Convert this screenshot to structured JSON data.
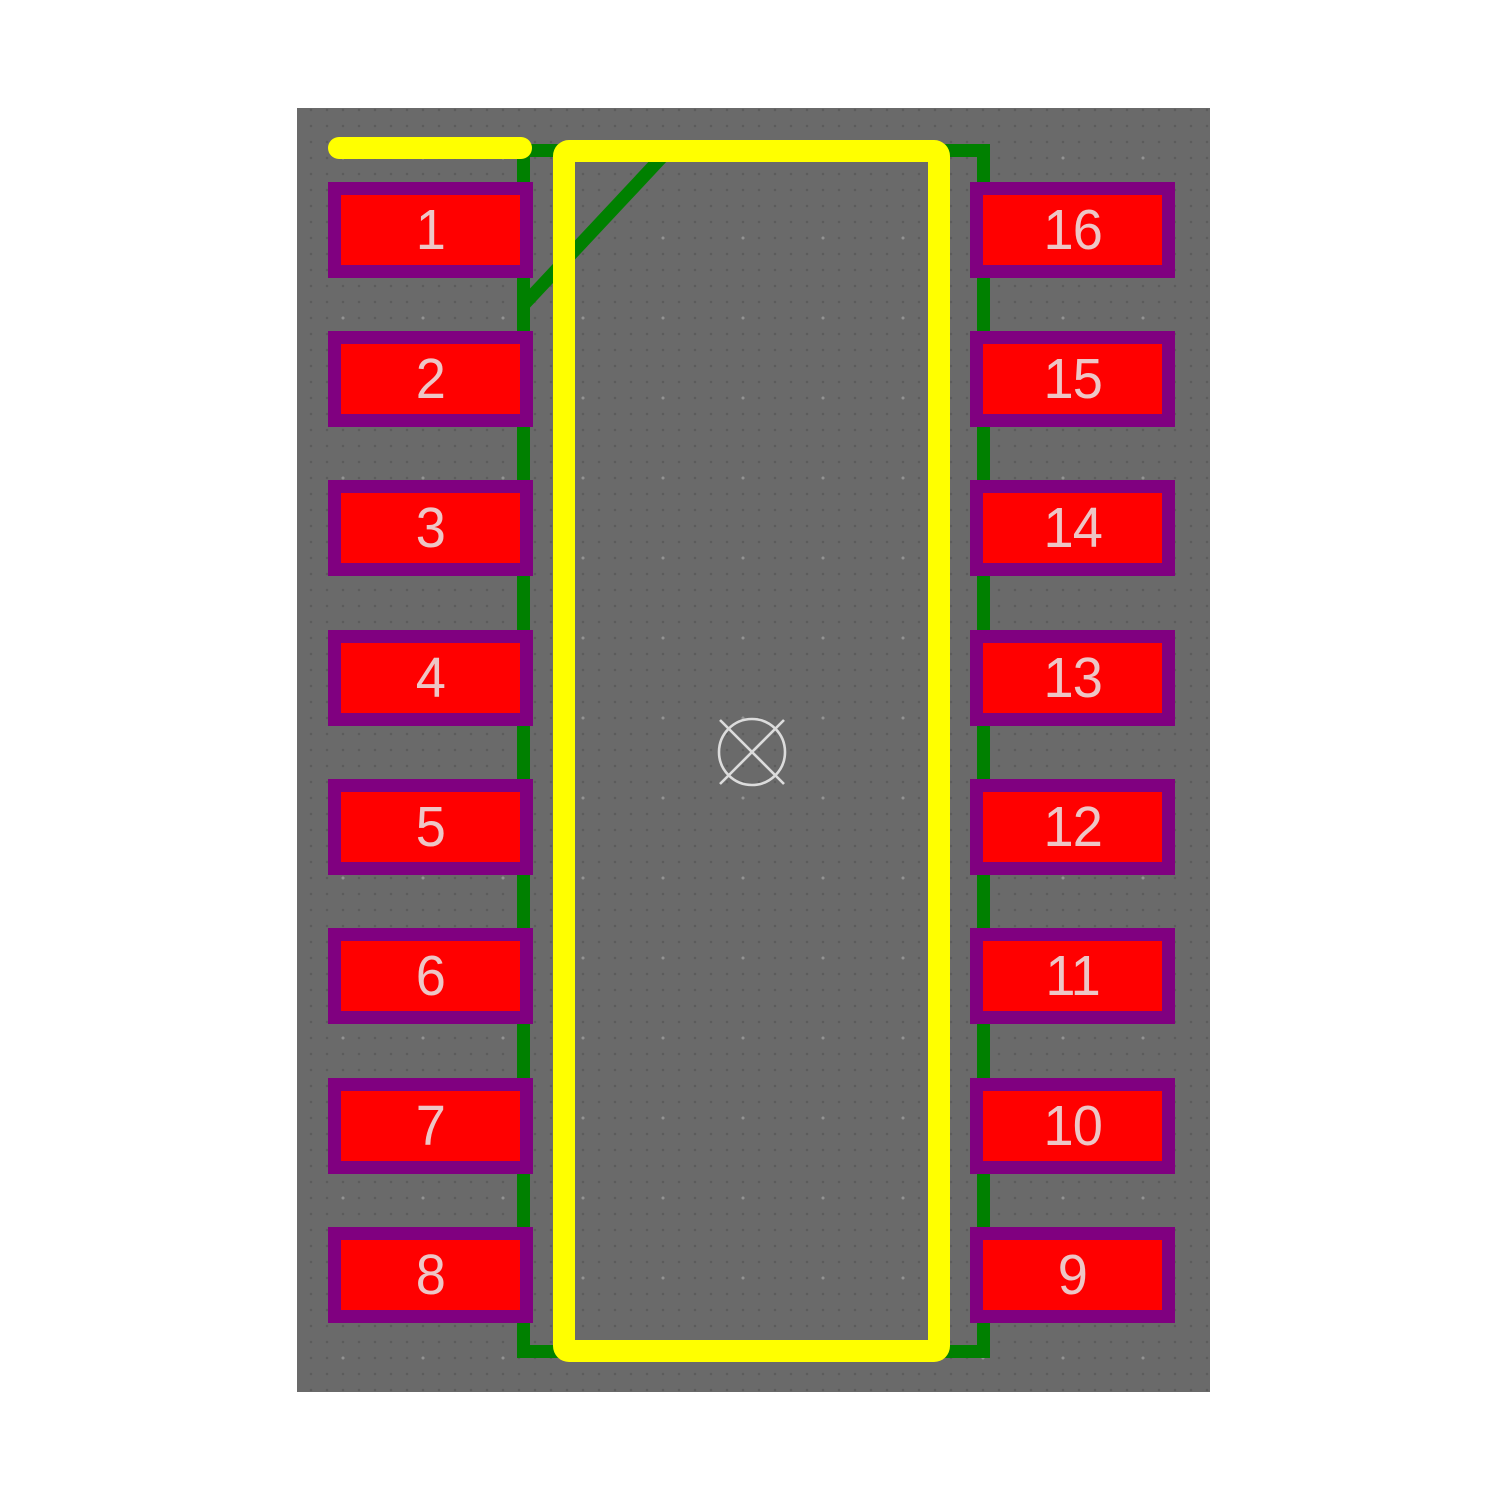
{
  "app": {
    "view": "pcb-footprint-editor",
    "component": "16-pin dual-row footprint"
  },
  "canvas": {
    "background_color": "#6a6a6a",
    "grid_fine_dot_color": "#5c5c5c",
    "grid_coarse_dot_color": "#929292"
  },
  "pads": {
    "fill_color": "#ff0000",
    "border_color": "#800080",
    "number_color": "#edc6c6",
    "left_column": [
      "1",
      "2",
      "3",
      "4",
      "5",
      "6",
      "7",
      "8"
    ],
    "right_column": [
      "16",
      "15",
      "14",
      "13",
      "12",
      "11",
      "10",
      "9"
    ]
  },
  "silkscreen": {
    "color": "#ffff00",
    "elements": [
      "body-rectangle",
      "pin1-bar"
    ]
  },
  "body_outline": {
    "color": "#008000",
    "elements": [
      "body-rectangle",
      "pin1-chamfer-diagonal"
    ]
  },
  "origin_marker": {
    "color": "#dcdcdc",
    "shape": "circle-with-x"
  }
}
